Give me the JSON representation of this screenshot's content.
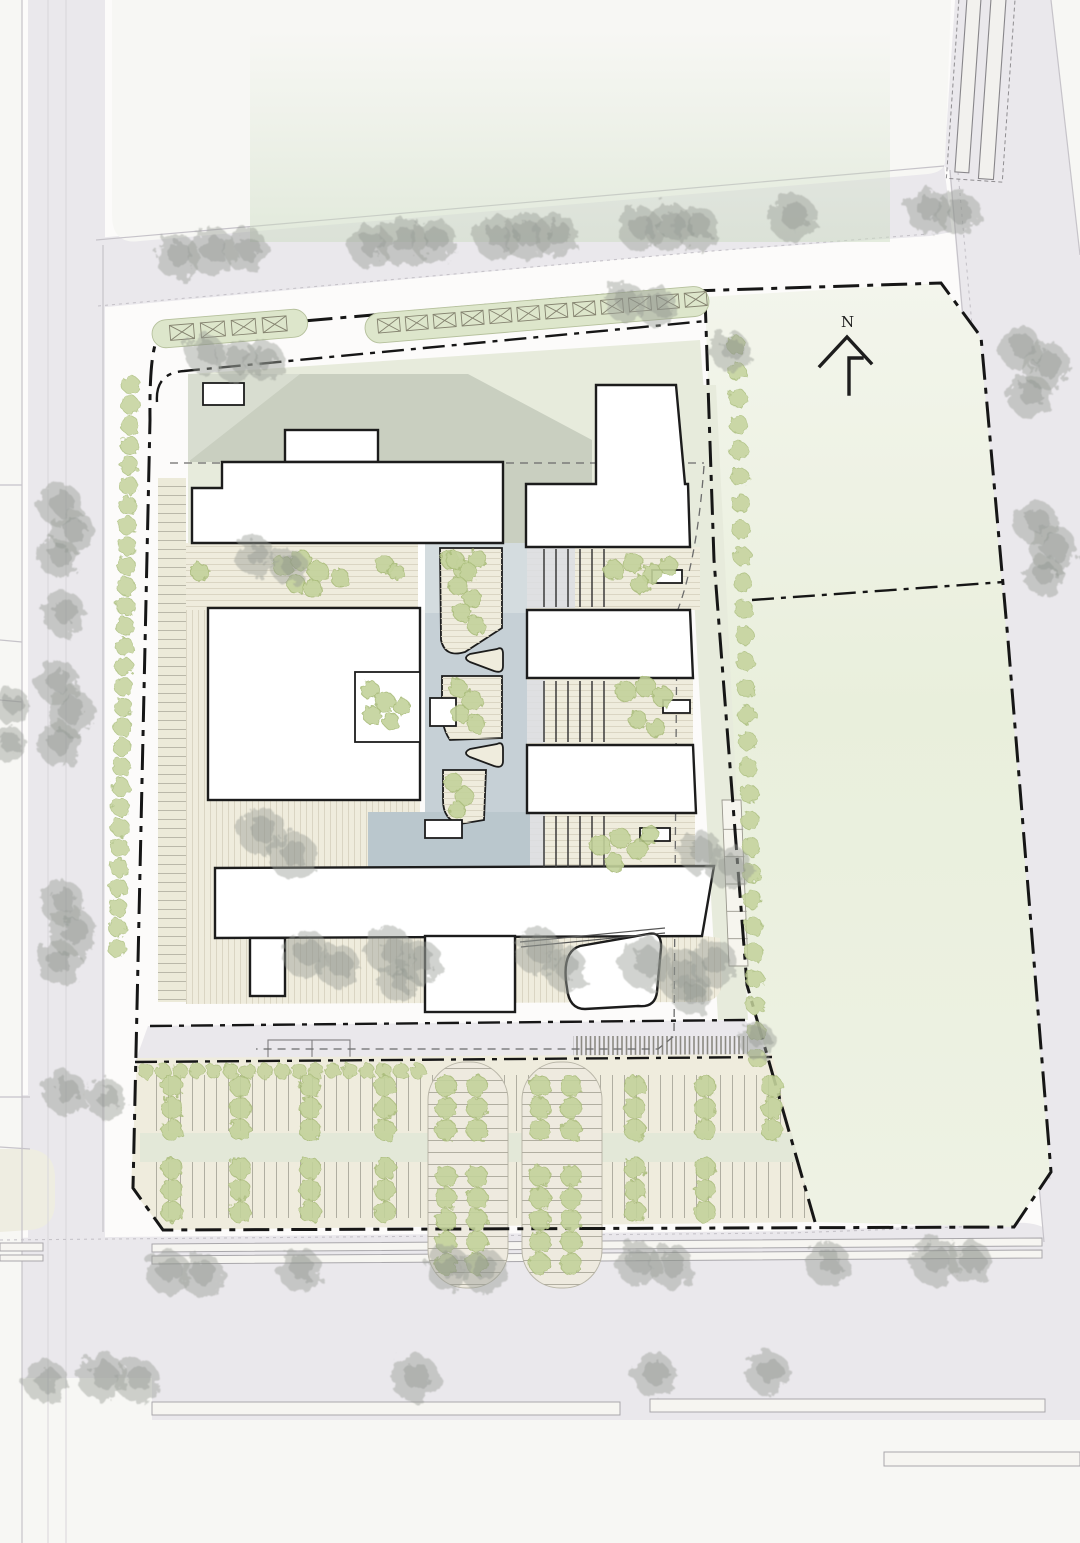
{
  "title": "architectural-site-plan",
  "north": {
    "label": "N"
  },
  "palette": {
    "bg": "#fcfbfa",
    "road": "#eae8ec",
    "block": "#f7f7f4",
    "block-warm": "#eeede1",
    "edge": "#c6c3c9",
    "lane": "#d8d6da",
    "cream": "#efecdd",
    "stripe": "#d8d3c0",
    "stall-line": "#aaa79a",
    "podium": "#c9cfc0",
    "podium-light": "#d8ddd0",
    "podium-pale": "#e7ebdc",
    "building": "#ffffff",
    "line-dark": "#1c1c1c",
    "line-mid": "#4d4d4d",
    "canyon": "#c6d0d6",
    "canyon-light": "#d4dcdf",
    "pool": "#bac7cd",
    "shrub": "#c3d29b",
    "shrub-edge": "#a9bc7a",
    "tree-gray": "#989e97",
    "pill-green": "#dde6cb",
    "pill-edge": "#b5c09c",
    "boundary": "#161616",
    "under": "#6b6b6b",
    "hatch": "#7c7a71",
    "field-hi": "#f3f5ec",
    "field-mid": "#e9efdc"
  },
  "trees_gray": [
    [
      178,
      257,
      22
    ],
    [
      212,
      251,
      24
    ],
    [
      246,
      250,
      22
    ],
    [
      370,
      246,
      22
    ],
    [
      403,
      242,
      24
    ],
    [
      434,
      241,
      22
    ],
    [
      496,
      238,
      22
    ],
    [
      526,
      236,
      24
    ],
    [
      556,
      235,
      22
    ],
    [
      640,
      229,
      22
    ],
    [
      669,
      227,
      24
    ],
    [
      697,
      228,
      22
    ],
    [
      793,
      218,
      24
    ],
    [
      928,
      211,
      22
    ],
    [
      958,
      213,
      22
    ],
    [
      1020,
      348,
      22
    ],
    [
      1046,
      366,
      24
    ],
    [
      1030,
      396,
      22
    ],
    [
      1036,
      523,
      22
    ],
    [
      1053,
      549,
      24
    ],
    [
      1043,
      575,
      20
    ],
    [
      60,
      505,
      22
    ],
    [
      73,
      532,
      22
    ],
    [
      58,
      557,
      20
    ],
    [
      64,
      614,
      22
    ],
    [
      57,
      682,
      22
    ],
    [
      70,
      712,
      24
    ],
    [
      59,
      744,
      22
    ],
    [
      12,
      706,
      18
    ],
    [
      8,
      744,
      18
    ],
    [
      62,
      902,
      22
    ],
    [
      73,
      933,
      24
    ],
    [
      58,
      963,
      22
    ],
    [
      65,
      1093,
      22
    ],
    [
      106,
      1099,
      20
    ],
    [
      168,
      1272,
      22
    ],
    [
      202,
      1275,
      22
    ],
    [
      300,
      1270,
      22
    ],
    [
      45,
      1381,
      22
    ],
    [
      102,
      1377,
      24
    ],
    [
      137,
      1380,
      22
    ],
    [
      448,
      1268,
      22
    ],
    [
      483,
      1270,
      22
    ],
    [
      638,
      1264,
      22
    ],
    [
      671,
      1266,
      22
    ],
    [
      415,
      1378,
      24
    ],
    [
      654,
      1375,
      22
    ],
    [
      768,
      1373,
      22
    ],
    [
      828,
      1264,
      22
    ],
    [
      934,
      1261,
      24
    ],
    [
      970,
      1262,
      22
    ],
    [
      205,
      354,
      20
    ],
    [
      236,
      361,
      22
    ],
    [
      264,
      360,
      20
    ],
    [
      256,
      557,
      20
    ],
    [
      289,
      567,
      18
    ],
    [
      262,
      832,
      24
    ],
    [
      293,
      856,
      24
    ],
    [
      306,
      954,
      24
    ],
    [
      338,
      966,
      22
    ],
    [
      390,
      951,
      24
    ],
    [
      420,
      962,
      22
    ],
    [
      398,
      981,
      20
    ],
    [
      538,
      951,
      24
    ],
    [
      565,
      969,
      22
    ],
    [
      645,
      963,
      26
    ],
    [
      682,
      975,
      26
    ],
    [
      713,
      963,
      24
    ],
    [
      692,
      996,
      20
    ],
    [
      700,
      852,
      22
    ],
    [
      730,
      868,
      22
    ],
    [
      625,
      302,
      20
    ],
    [
      657,
      307,
      20
    ],
    [
      730,
      351,
      20
    ],
    [
      757,
      1040,
      18
    ]
  ],
  "shrubs": [
    [
      200,
      572,
      9
    ],
    [
      283,
      566,
      10
    ],
    [
      301,
      560,
      10
    ],
    [
      318,
      571,
      10
    ],
    [
      296,
      584,
      9
    ],
    [
      313,
      589,
      9
    ],
    [
      340,
      578,
      9
    ],
    [
      385,
      565,
      9
    ],
    [
      396,
      572,
      8
    ],
    [
      450,
      560,
      9
    ],
    [
      464,
      570,
      10
    ],
    [
      477,
      559,
      9
    ],
    [
      613,
      570,
      10
    ],
    [
      633,
      563,
      10
    ],
    [
      652,
      574,
      10
    ],
    [
      669,
      566,
      9
    ],
    [
      640,
      584,
      9
    ],
    [
      626,
      692,
      10
    ],
    [
      646,
      687,
      10
    ],
    [
      663,
      697,
      10
    ],
    [
      638,
      720,
      9
    ],
    [
      656,
      728,
      9
    ],
    [
      600,
      845,
      10
    ],
    [
      620,
      838,
      10
    ],
    [
      638,
      850,
      10
    ],
    [
      614,
      862,
      9
    ],
    [
      650,
      835,
      9
    ],
    [
      455,
      560,
      9
    ],
    [
      468,
      572,
      9
    ],
    [
      458,
      586,
      9
    ],
    [
      472,
      598,
      9
    ],
    [
      462,
      612,
      9
    ],
    [
      476,
      625,
      9
    ],
    [
      458,
      688,
      9
    ],
    [
      472,
      700,
      10
    ],
    [
      460,
      714,
      9
    ],
    [
      476,
      724,
      9
    ],
    [
      453,
      782,
      9
    ],
    [
      464,
      796,
      9
    ],
    [
      457,
      810,
      8
    ],
    [
      370,
      690,
      9
    ],
    [
      385,
      702,
      10
    ],
    [
      372,
      715,
      9
    ],
    [
      391,
      721,
      8
    ],
    [
      402,
      707,
      8
    ]
  ],
  "hedges": [
    {
      "name": "hedge-left-road",
      "x0": 131,
      "y0": 385,
      "x1": 117,
      "y1": 948,
      "step": 20,
      "r": 9
    },
    {
      "name": "hedge-field-west",
      "x0": 736,
      "y0": 345,
      "x1": 757,
      "y1": 1058,
      "step": 26,
      "r": 9
    },
    {
      "name": "hedge-parking-top",
      "x0": 146,
      "y0": 1071,
      "x1": 418,
      "y1": 1071,
      "step": 17,
      "r": 7.5
    }
  ],
  "parking_tree_columns": [
    {
      "x": 172,
      "ys": [
        1086,
        1108,
        1130,
        1168,
        1190,
        1212
      ]
    },
    {
      "x": 240,
      "ys": [
        1086,
        1108,
        1130,
        1168,
        1190,
        1212
      ]
    },
    {
      "x": 310,
      "ys": [
        1086,
        1108,
        1130,
        1168,
        1190,
        1212
      ]
    },
    {
      "x": 385,
      "ys": [
        1086,
        1108,
        1130,
        1168,
        1190,
        1212
      ]
    },
    {
      "x": 635,
      "ys": [
        1086,
        1108,
        1130,
        1168,
        1190,
        1212
      ]
    },
    {
      "x": 705,
      "ys": [
        1086,
        1108,
        1130,
        1168,
        1190,
        1212
      ]
    },
    {
      "x": 772,
      "ys": [
        1086,
        1108,
        1130
      ]
    },
    {
      "x": 446,
      "ys": [
        1086,
        1108,
        1130,
        1176,
        1198,
        1220,
        1242,
        1264
      ]
    },
    {
      "x": 477,
      "ys": [
        1086,
        1108,
        1130,
        1176,
        1198,
        1220,
        1242,
        1264
      ]
    },
    {
      "x": 540,
      "ys": [
        1086,
        1108,
        1130,
        1176,
        1198,
        1220,
        1242,
        1264
      ]
    },
    {
      "x": 571,
      "ys": [
        1086,
        1108,
        1130,
        1176,
        1198,
        1220,
        1242,
        1264
      ]
    }
  ],
  "pill_stalls": [
    {
      "target": "pill1-stalls",
      "x0": 170,
      "y": 326,
      "w": 24,
      "h": 15,
      "step": 31,
      "n": 4
    },
    {
      "target": "pill2-stalls",
      "x0": 378,
      "y": 320,
      "w": 22,
      "h": 14,
      "step": 28,
      "n": 12
    }
  ],
  "stair_cores": {
    "x0": 544,
    "step": 12,
    "n": 6,
    "bands": [
      [
        549,
        607
      ],
      [
        681,
        742
      ],
      [
        816,
        867
      ]
    ]
  },
  "verge_strip": {
    "x": 723,
    "y": 802,
    "w": 19,
    "h": 164,
    "lines": 6
  }
}
